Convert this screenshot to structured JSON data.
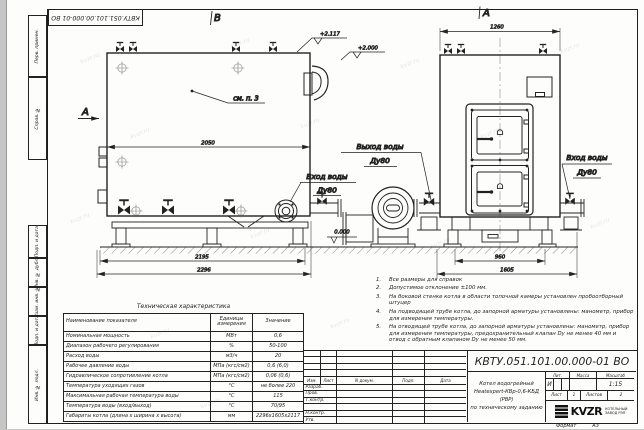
{
  "page": {
    "stamp": "КВТУ.051.101.00.000-01 ВО",
    "watermark": "kvzr.ru",
    "format_label": "Формат",
    "format_value": "А3"
  },
  "margin": {
    "labels": [
      "Перв. примен.",
      "Справ. №",
      "Подп. и дата",
      "Инв. № дубл.",
      "Взам. инв. №",
      "Подп. и дата",
      "Инв. № подл."
    ]
  },
  "drawing": {
    "view_b": "В",
    "view_a": "А",
    "section_a": "А",
    "callout_note": "см. п. 3",
    "dims": {
      "b_top": "2050",
      "b_mid": "2195",
      "b_bot": "2296",
      "a_top": "1260",
      "a_mid": "960",
      "a_bot": "1605"
    },
    "elevations": {
      "top": "+2.117",
      "mid": "+2.000",
      "zero": "0.000"
    },
    "labels": {
      "outlet1": "Выход воды",
      "outlet2": "Ду80",
      "inlet_b1": "Вход воды",
      "inlet_b2": "Ду80",
      "inlet_a1": "Вход воды",
      "inlet_a2": "Ду80"
    }
  },
  "notes": {
    "items": [
      {
        "num": "1.",
        "text": "Все размеры для справок"
      },
      {
        "num": "2.",
        "text": "Допустимое отклонение ±100 мм."
      },
      {
        "num": "3.",
        "text": "На боковой стенке котла в области топочной камеры установлен пробоотборный штуцер"
      },
      {
        "num": "4.",
        "text": "На подводящей трубе котла, до запорной арматуры установлены: манометр, прибор для измерения температуры."
      },
      {
        "num": "5.",
        "text": "На отводящей трубе котла, до запорной арматуры установлены: манометр, прибор для измерения температуры, предохранительный клапан Dу не менее 40 мм и отвод с обратным клапаном Dу не менее 50 мм."
      }
    ]
  },
  "tech_table": {
    "title": "Техническая характеристика",
    "headers": {
      "name": "Наименование показателя",
      "units": "Единицы измерения",
      "value": "Значение"
    },
    "rows": [
      {
        "name": "Номинальная мощность",
        "units": "МВт",
        "value": "0,6"
      },
      {
        "name": "Диапазон рабочего регулирования",
        "units": "%",
        "value": "50-100"
      },
      {
        "name": "Расход воды",
        "units": "м3/ч",
        "value": "20"
      },
      {
        "name": "Рабочее давление воды",
        "units": "МПа (кгс/см2)",
        "value": "0,6 (6,0)"
      },
      {
        "name": "Гидравлическое сопротивление котла",
        "units": "МПа (кгс/см2)",
        "value": "0,06 (0,6)"
      },
      {
        "name": "Температура уходящих газов",
        "units": "°С",
        "value": "не более 220"
      },
      {
        "name": "Максимальная рабочая температура воды",
        "units": "°С",
        "value": "115"
      },
      {
        "name": "Температура воды (вход/выход)",
        "units": "°С",
        "value": "70/95"
      },
      {
        "name": "Габариты котла (длина х ширина х высота)",
        "units": "мм",
        "value": "2296х1605х2117"
      }
    ]
  },
  "title_block": {
    "doc_number": "КВТУ.051.101.00.000-01 ВО",
    "product": {
      "line1": "Котел водогрейный",
      "line2": "Heatexpert-КВр-0,6-КБД (РВР)",
      "line3": "по техническому заданию"
    },
    "sig_cols": [
      "Изм.",
      "Лист",
      "N докум.",
      "Подп.",
      "Дата"
    ],
    "sig_rows": [
      "Разраб.",
      "Пров.",
      "Т.контр.",
      "",
      "Н.контр.",
      "Утв."
    ],
    "lit_h": "Лит.",
    "mass_h": "Масса",
    "scale_h": "Масштаб",
    "lit_v": "И",
    "scale_v": "1:15",
    "sheet_h": "Лист",
    "sheet_v": "1",
    "sheets_h": "Листов",
    "sheets_v": "2",
    "logo_text": "KVZR",
    "logo_line1": "КОТЕЛЬНЫЙ",
    "logo_line2": "ЗАВОД РЭП"
  }
}
